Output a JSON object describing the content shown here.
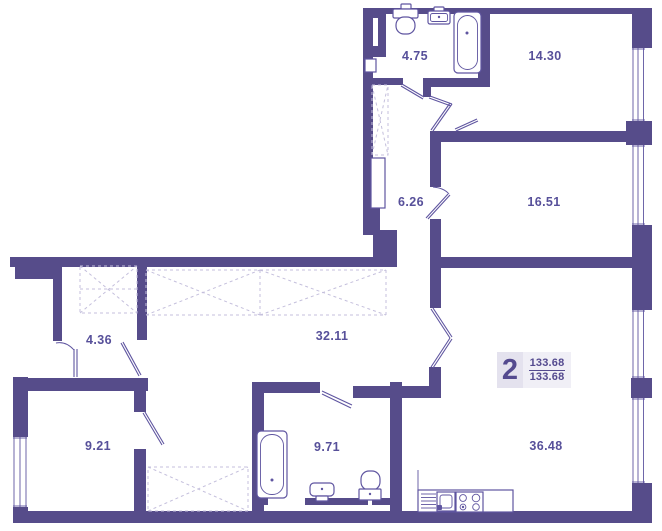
{
  "plan": {
    "kind": "apartment-floor-plan",
    "badge": {
      "rooms_count": "2",
      "area_top": "133.68",
      "area_bottom": "133.68"
    },
    "rooms": [
      {
        "name": "bathroom-top",
        "area": "4.75"
      },
      {
        "name": "bedroom-top",
        "area": "14.30"
      },
      {
        "name": "hallway-upper",
        "area": "6.26"
      },
      {
        "name": "bedroom-right",
        "area": "16.51"
      },
      {
        "name": "entry-hall",
        "area": "4.36"
      },
      {
        "name": "corridor",
        "area": "32.11"
      },
      {
        "name": "room-left",
        "area": "9.21"
      },
      {
        "name": "bathroom-main",
        "area": "9.71"
      },
      {
        "name": "living-kitchen",
        "area": "36.48"
      }
    ],
    "fixtures": [
      "toilet",
      "wash-basin",
      "bathtub",
      "bathtub",
      "wash-basin",
      "toilet",
      "kitchen-sink",
      "stove",
      "wardrobe",
      "ventilation-shaft"
    ],
    "colors": {
      "wall": "#564c8a",
      "line": "#5f55a0",
      "dash": "#c4bfdc",
      "label": "#57509a",
      "badge_num": "#544a8f",
      "badge_bg_count": "#e4e2ee",
      "badge_bg_areas": "#f0eff6"
    }
  }
}
